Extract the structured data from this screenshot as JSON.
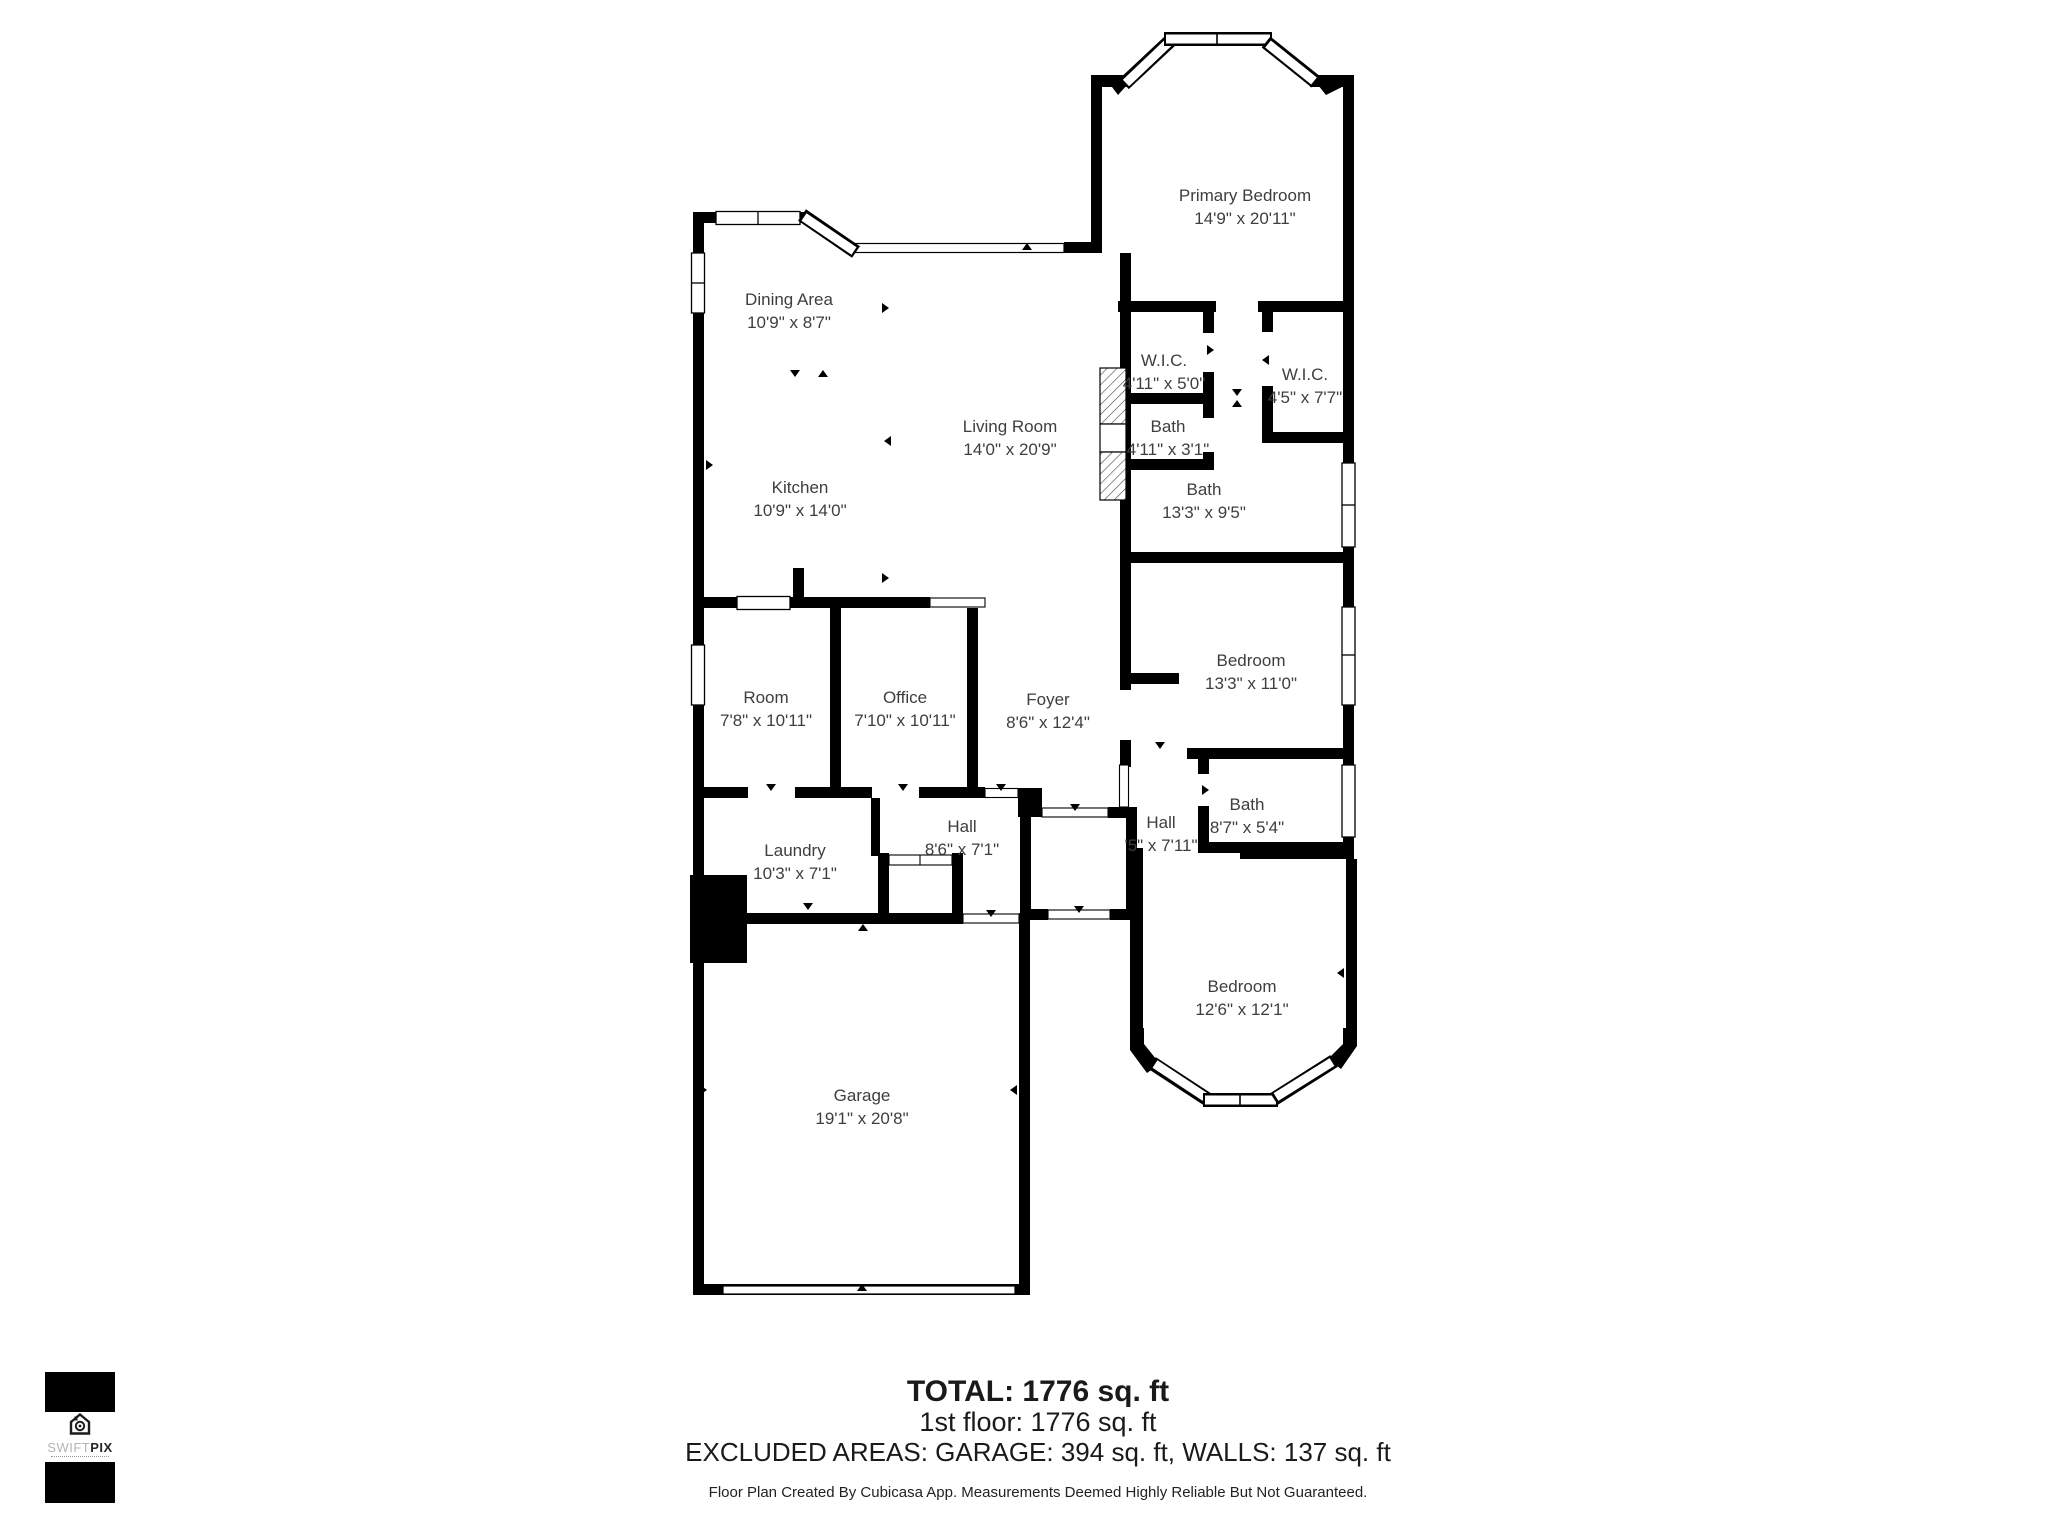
{
  "plan": {
    "rooms": [
      {
        "name": "Primary Bedroom",
        "dims": "14'9\" x 20'11\""
      },
      {
        "name": "Dining Area",
        "dims": "10'9\" x 8'7\""
      },
      {
        "name": "Living Room",
        "dims": "14'0\" x 20'9\""
      },
      {
        "name": "Kitchen",
        "dims": "10'9\" x 14'0\""
      },
      {
        "name": "W.I.C.",
        "dims": "4'11\" x 5'0\""
      },
      {
        "name": "W.I.C.",
        "dims": "4'5\" x 7'7\""
      },
      {
        "name": "Bath",
        "dims": "4'11\" x 3'1\""
      },
      {
        "name": "Bath",
        "dims": "13'3\" x 9'5\""
      },
      {
        "name": "Room",
        "dims": "7'8\" x 10'11\""
      },
      {
        "name": "Office",
        "dims": "7'10\" x 10'11\""
      },
      {
        "name": "Foyer",
        "dims": "8'6\" x 12'4\""
      },
      {
        "name": "Bedroom",
        "dims": "13'3\" x 11'0\""
      },
      {
        "name": "Hall",
        "dims": "'5\" x 7'11\""
      },
      {
        "name": "Bath",
        "dims": "8'7\" x 5'4\""
      },
      {
        "name": "Laundry",
        "dims": "10'3\" x 7'1\""
      },
      {
        "name": "Hall",
        "dims": "8'6\" x 7'1\""
      },
      {
        "name": "Bedroom",
        "dims": "12'6\" x 12'1\""
      },
      {
        "name": "Garage",
        "dims": "19'1\" x 20'8\""
      }
    ]
  },
  "summary": {
    "total": "TOTAL: 1776 sq. ft",
    "floor1": "1st floor: 1776 sq. ft",
    "excluded": "EXCLUDED AREAS: GARAGE: 394 sq. ft, WALLS: 137 sq. ft",
    "disclaimer": "Floor Plan Created By Cubicasa App. Measurements Deemed Highly Reliable But Not Guaranteed."
  },
  "logo": {
    "brand_light": "SWIFT",
    "brand_bold": "PIX"
  },
  "colors": {
    "wall": "#000000",
    "floor": "#ffffff",
    "label_text": "#3e3e3e"
  }
}
